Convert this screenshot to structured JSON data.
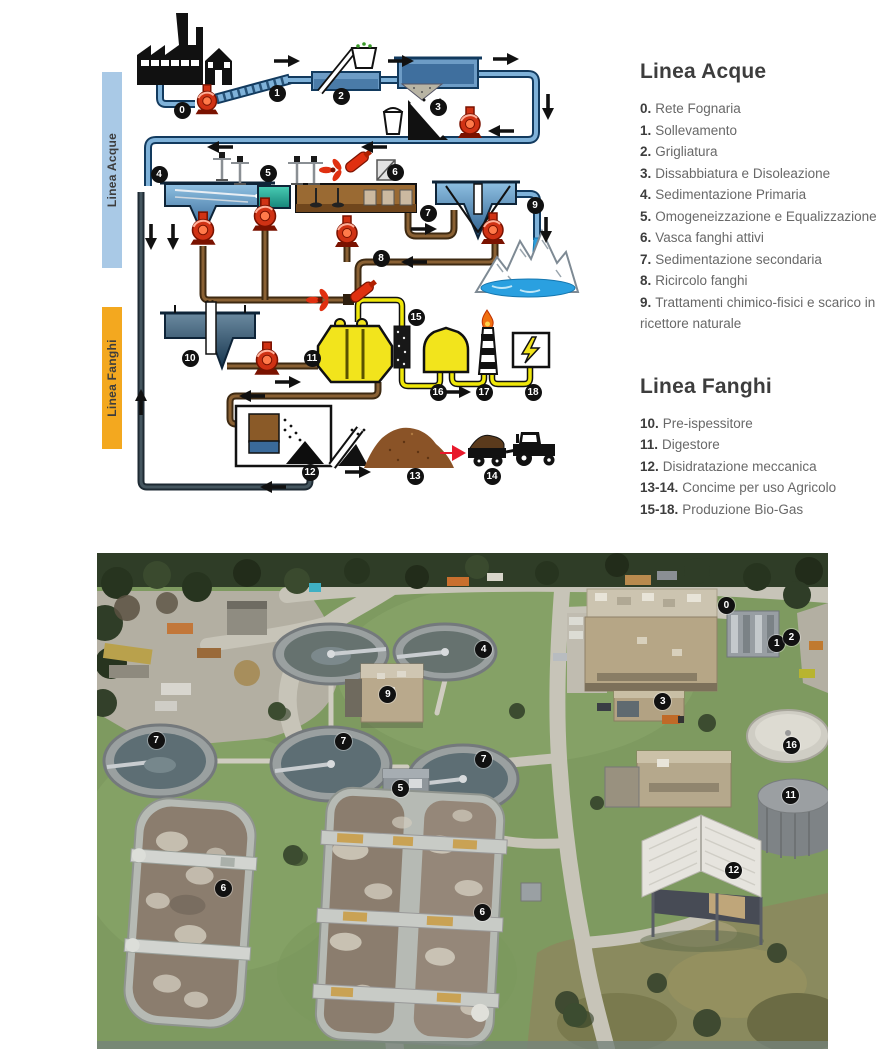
{
  "diagram": {
    "bar_acque": "Linea Acque",
    "bar_fanghi": "Linea Fanghi",
    "icons": [
      "factory-icon",
      "house-icon",
      "pump-icon",
      "screen-icon",
      "basket-icon",
      "bucket-icon",
      "grit-chute-icon",
      "mixer-icon",
      "propeller-mixer-icon",
      "submersible-mixer-icon",
      "blower-icon",
      "mountains-waterfall-icon",
      "pre-thickener-icon",
      "digester-icon",
      "gas-filter-icon",
      "gas-holder-icon",
      "flare-icon",
      "power-box-icon",
      "dewatering-icon",
      "conveyor-icon",
      "sludge-pile-icon",
      "tractor-icon"
    ],
    "markers": [
      {
        "n": "0",
        "x": "182px",
        "y": "110px"
      },
      {
        "n": "1",
        "x": "277px",
        "y": "93px"
      },
      {
        "n": "2",
        "x": "341px",
        "y": "96px"
      },
      {
        "n": "3",
        "x": "438px",
        "y": "107px"
      },
      {
        "n": "4",
        "x": "159px",
        "y": "174px"
      },
      {
        "n": "5",
        "x": "268px",
        "y": "173px"
      },
      {
        "n": "6",
        "x": "395px",
        "y": "172px"
      },
      {
        "n": "7",
        "x": "428px",
        "y": "213px"
      },
      {
        "n": "8",
        "x": "381px",
        "y": "258px"
      },
      {
        "n": "9",
        "x": "535px",
        "y": "205px"
      },
      {
        "n": "10",
        "x": "190px",
        "y": "358px"
      },
      {
        "n": "11",
        "x": "312px",
        "y": "358px"
      },
      {
        "n": "12",
        "x": "310px",
        "y": "472px"
      },
      {
        "n": "13",
        "x": "415px",
        "y": "476px"
      },
      {
        "n": "14",
        "x": "492px",
        "y": "476px"
      },
      {
        "n": "15",
        "x": "416px",
        "y": "317px"
      },
      {
        "n": "16",
        "x": "438px",
        "y": "392px"
      },
      {
        "n": "17",
        "x": "484px",
        "y": "392px"
      },
      {
        "n": "18",
        "x": "533px",
        "y": "392px"
      }
    ]
  },
  "legend_acque": {
    "title": "Linea Acque",
    "items": [
      {
        "num": "0.",
        "label": "Rete Fognaria"
      },
      {
        "num": "1.",
        "label": "Sollevamento"
      },
      {
        "num": "2.",
        "label": "Grigliatura"
      },
      {
        "num": "3.",
        "label": "Dissabbiatura e Disoleazione"
      },
      {
        "num": "4.",
        "label": "Sedimentazione Primaria"
      },
      {
        "num": "5.",
        "label": "Omogeneizzazione e Equalizzazione"
      },
      {
        "num": "6.",
        "label": "Vasca fanghi attivi"
      },
      {
        "num": "7.",
        "label": "Sedimentazione secondaria"
      },
      {
        "num": "8.",
        "label": "Ricircolo fanghi"
      },
      {
        "num": "9.",
        "label": "Trattamenti chimico-fisici e scarico in ricettore naturale"
      }
    ]
  },
  "legend_fanghi": {
    "title": "Linea Fanghi",
    "items": [
      {
        "num": "10.",
        "label": "Pre-ispessitore"
      },
      {
        "num": "11.",
        "label": "Digestore"
      },
      {
        "num": "12.",
        "label": "Disidratazione meccanica"
      },
      {
        "num": "13-14.",
        "label": "Concime per uso Agricolo"
      },
      {
        "num": "15-18.",
        "label": "Produzione Bio-Gas"
      }
    ]
  },
  "photo": {
    "description": "Aerial view of wastewater treatment plant with numbered process units",
    "markers": [
      {
        "n": "0",
        "x": "86.1%",
        "y": "10.5%"
      },
      {
        "n": "1",
        "x": "93%",
        "y": "18.3%"
      },
      {
        "n": "2",
        "x": "95%",
        "y": "17.1%"
      },
      {
        "n": "3",
        "x": "77.4%",
        "y": "30%"
      },
      {
        "n": "4",
        "x": "52.9%",
        "y": "19.4%"
      },
      {
        "n": "9",
        "x": "39.8%",
        "y": "28.6%"
      },
      {
        "n": "7",
        "x": "8.1%",
        "y": "37.8%"
      },
      {
        "n": "7",
        "x": "33.7%",
        "y": "38%"
      },
      {
        "n": "7",
        "x": "52.9%",
        "y": "41.7%"
      },
      {
        "n": "5",
        "x": "41.5%",
        "y": "47.4%"
      },
      {
        "n": "16",
        "x": "95%",
        "y": "38.9%"
      },
      {
        "n": "11",
        "x": "94.9%",
        "y": "48.9%"
      },
      {
        "n": "6",
        "x": "17.3%",
        "y": "67.7%"
      },
      {
        "n": "6",
        "x": "52.7%",
        "y": "72.4%"
      },
      {
        "n": "12",
        "x": "87.1%",
        "y": "64.1%"
      }
    ]
  },
  "colors": {
    "acque_bar": "#a9c9e6",
    "fanghi_bar": "#f3a81f",
    "marker_bg": "#111111",
    "title_text": "#3d3d3d",
    "body_text": "#686868",
    "pump_red": "#d03214",
    "digester_yellow": "#f2e41c",
    "water_blue": "#5b8fc0",
    "pipe_blue": "#123a5e",
    "sludge_brown": "#6b4a26",
    "equalization_teal": "#2fb39a",
    "grass_green": "#7e9a60"
  }
}
